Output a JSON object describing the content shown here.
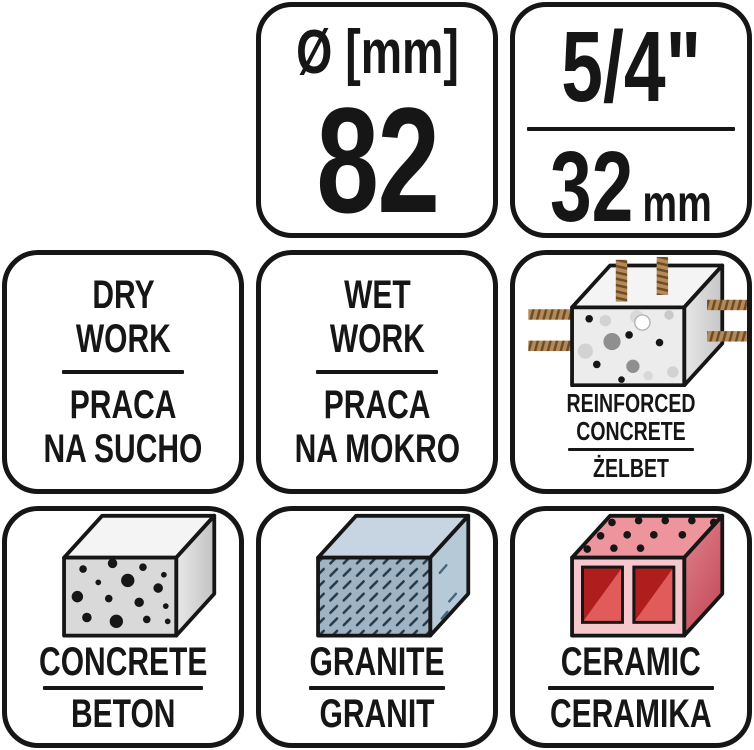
{
  "palette": {
    "outline": "#161616",
    "background": "#ffffff",
    "text": "#161616",
    "rebar": "#b5895a",
    "rebar_rib": "#6b4d24",
    "concrete_front": "#d9d9d9",
    "concrete_top": "#f4f4f4",
    "concrete_side_light": "#e9e9e9",
    "concrete_side_dark": "#c2c2c2",
    "reinforced_front": "#ececec",
    "granite_front": "#9fb3c3",
    "granite_top": "#c6d5e1",
    "granite_side": "#b5c9d7",
    "granite_hatch": "#24384a",
    "ceramic_top": "#ee949c",
    "ceramic_front": "#f6c7cd",
    "ceramic_side_light": "#e2848e",
    "ceramic_side_dark": "#c44d5b",
    "ceramic_hole_dark": "#b01d1d",
    "ceramic_hole_light": "#e25b5b"
  },
  "cells": {
    "diameter": {
      "label": "Ø [mm]",
      "value": "82"
    },
    "connector": {
      "inch": "5/4\"",
      "mm_value": "32",
      "mm_unit": "mm"
    },
    "dry": {
      "line1": "DRY",
      "line2": "WORK",
      "line3": "PRACA",
      "line4": "NA SUCHO"
    },
    "wet": {
      "line1": "WET",
      "line2": "WORK",
      "line3": "PRACA",
      "line4": "NA MOKRO"
    },
    "reinforced": {
      "icon": "reinforced-concrete-block",
      "line1": "REINFORCED",
      "line2": "CONCRETE",
      "line3": "ŻELBET"
    },
    "concrete": {
      "icon": "concrete-block",
      "en": "CONCRETE",
      "pl": "BETON"
    },
    "granite": {
      "icon": "granite-block",
      "en": "GRANITE",
      "pl": "GRANIT"
    },
    "ceramic": {
      "icon": "ceramic-hollow-brick",
      "en": "CERAMIC",
      "pl": "CERAMIKA"
    }
  }
}
